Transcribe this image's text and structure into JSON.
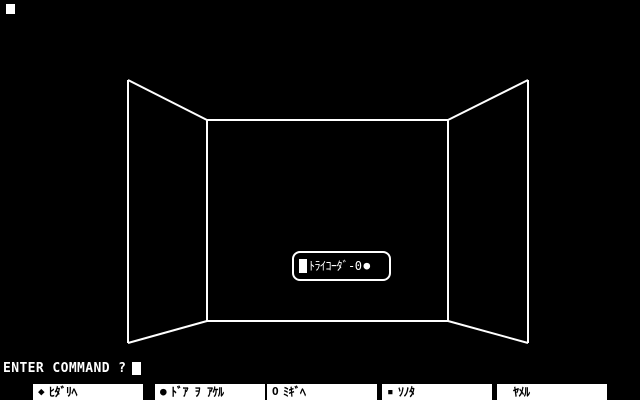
{
  "scene": {
    "background_color": "#000000",
    "line_color": "#ffffff",
    "description": "first-person wireframe room view"
  },
  "tricorder_box": {
    "cursor_block": "block",
    "label": "ﾄﾗｲｺｰﾀﾞ-0",
    "bullet_glyph": "●"
  },
  "command_line": {
    "prompt": "ENTER COMMAND ?",
    "cursor": "block"
  },
  "menu": {
    "items": [
      {
        "icon": "filled-diamond",
        "icon_glyph": "◆",
        "label": "ﾋﾀﾞﾘﾍ"
      },
      {
        "icon": "filled-circle",
        "icon_glyph": "●",
        "label": "ﾄﾞｱ ｦ ｱｹﾙ"
      },
      {
        "icon": "open-circle",
        "icon_glyph": "O",
        "label": "ﾐｷﾞﾍ"
      },
      {
        "icon": "small-square",
        "icon_glyph": "▪",
        "label": "ｿﾉﾀ"
      },
      {
        "icon": "none",
        "icon_glyph": "",
        "label": "ﾔﾒﾙ"
      }
    ]
  }
}
